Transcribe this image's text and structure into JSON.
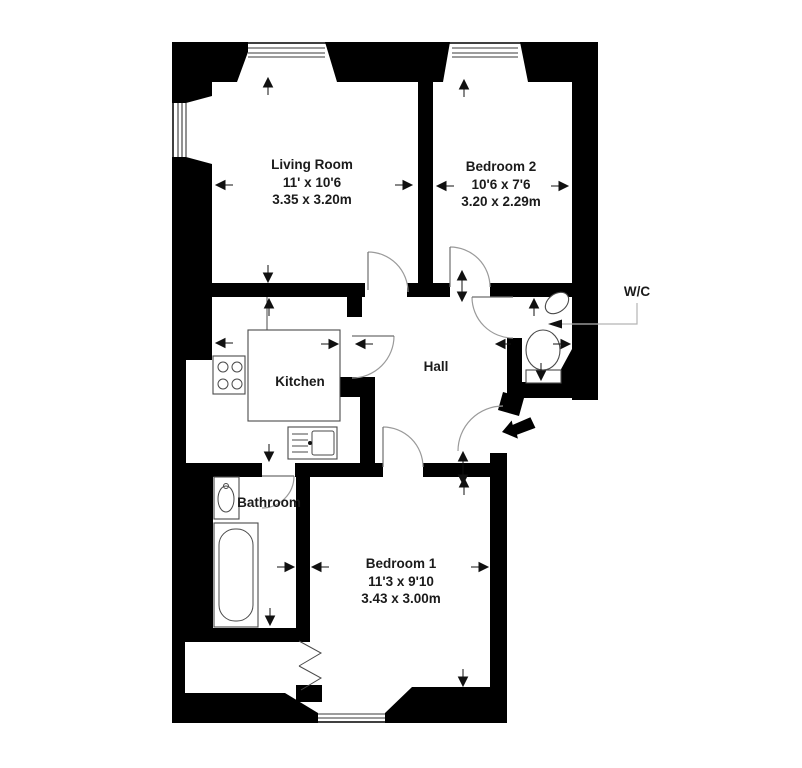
{
  "rooms": {
    "living_room": {
      "name": "Living Room",
      "size_imperial": "11' x 10'6",
      "size_metric": "3.35 x 3.20m"
    },
    "bedroom_2": {
      "name": "Bedroom 2",
      "size_imperial": "10'6 x 7'6",
      "size_metric": "3.20 x 2.29m"
    },
    "kitchen": {
      "name": "Kitchen"
    },
    "hall": {
      "name": "Hall"
    },
    "wc": {
      "name": "W/C"
    },
    "bathroom": {
      "name": "Bathroom"
    },
    "bedroom_1": {
      "name": "Bedroom 1",
      "size_imperial": "11'3 x 9'10",
      "size_metric": "3.43 x 3.00m"
    }
  },
  "colors": {
    "wall": "#000000",
    "label_text": "#1b1b1b",
    "door_arc": "#9a9a9a",
    "fixture_line": "#4a4a4a",
    "leader_line": "#b3b3b3",
    "entry_arrow": "#000000"
  }
}
